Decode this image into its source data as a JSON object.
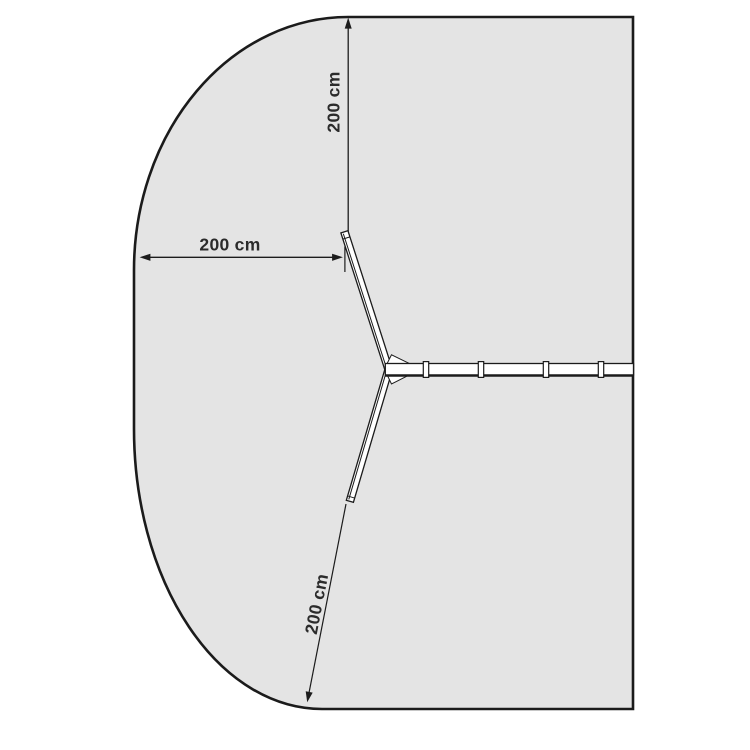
{
  "diagram": {
    "description": "Top view of a swing frame showing required safety clearances around the safety zone",
    "dimensions": {
      "top_clearance": "200 cm",
      "left_clearance": "200 cm",
      "bottom_clearance": "200 cm"
    },
    "colors": {
      "background": "#ffffff",
      "zone_fill": "#e4e4e4",
      "outline": "#1b1b1b",
      "structure_fill": "#ffffff",
      "label_text": "#2b2b2b"
    }
  }
}
